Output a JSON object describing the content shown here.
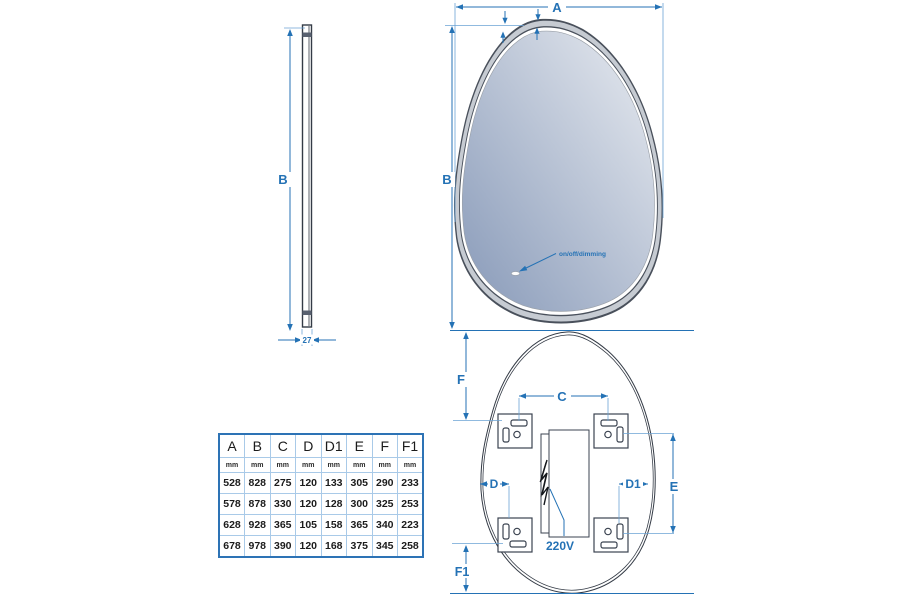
{
  "drawing": {
    "title": "led-mirror-technical-drawing",
    "colors": {
      "dimension_accent": "#2472b5",
      "outline": "#343b46",
      "frame_band": "#c6cbd2",
      "mirror_gradient_dark": "#8799b8",
      "mirror_gradient_light": "#e9ecf1",
      "table_border": "#2d73b5",
      "table_grid": "#a9cae8"
    },
    "side_view": {
      "b": "B",
      "depth": "27"
    },
    "front_view": {
      "a": "A",
      "b": "B",
      "sensor": "on/off/dimming"
    },
    "back_view": {
      "c": "C",
      "d": "D",
      "d1": "D1",
      "e": "E",
      "f": "F",
      "f1": "F1",
      "power": "220V"
    }
  },
  "table": {
    "headers": [
      "A",
      "B",
      "C",
      "D",
      "D1",
      "E",
      "F",
      "F1"
    ],
    "units": [
      "mm",
      "mm",
      "mm",
      "mm",
      "mm",
      "mm",
      "mm",
      "mm"
    ],
    "rows": [
      [
        "528",
        "828",
        "275",
        "120",
        "133",
        "305",
        "290",
        "233"
      ],
      [
        "578",
        "878",
        "330",
        "120",
        "128",
        "300",
        "325",
        "253"
      ],
      [
        "628",
        "928",
        "365",
        "105",
        "158",
        "365",
        "340",
        "223"
      ],
      [
        "678",
        "978",
        "390",
        "120",
        "168",
        "375",
        "345",
        "258"
      ]
    ]
  }
}
